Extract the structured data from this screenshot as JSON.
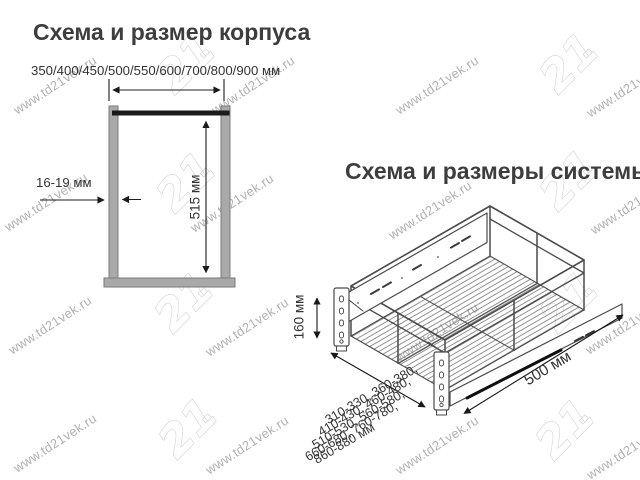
{
  "watermark": {
    "text": "www.td21vek.ru",
    "logo_text": "21"
  },
  "cabinet": {
    "title": "Схема и размер корпуса",
    "width_options_label": "350/400/450/500/550/600/700/800/900 мм",
    "panel_thickness_label": "16-19 мм",
    "inner_height_label": "515 мм"
  },
  "system": {
    "title": "Схема и размеры системы",
    "height_label": "160 мм",
    "depth_label": "500 мм",
    "width_lines": [
      "310-330, 360-380,",
      "410-430, 460-480,",
      "510-530, 560-580,",
      "660-680, 760-780,",
      "860-880 мм"
    ]
  },
  "colors": {
    "text": "#3d3d3d",
    "dim_line": "#1a1a1a",
    "drawing_line": "#4a4a4a",
    "panel_fill": "#a9a9a9",
    "panel_stroke": "#7a7a7a",
    "watermark": "#b2b2b2"
  }
}
